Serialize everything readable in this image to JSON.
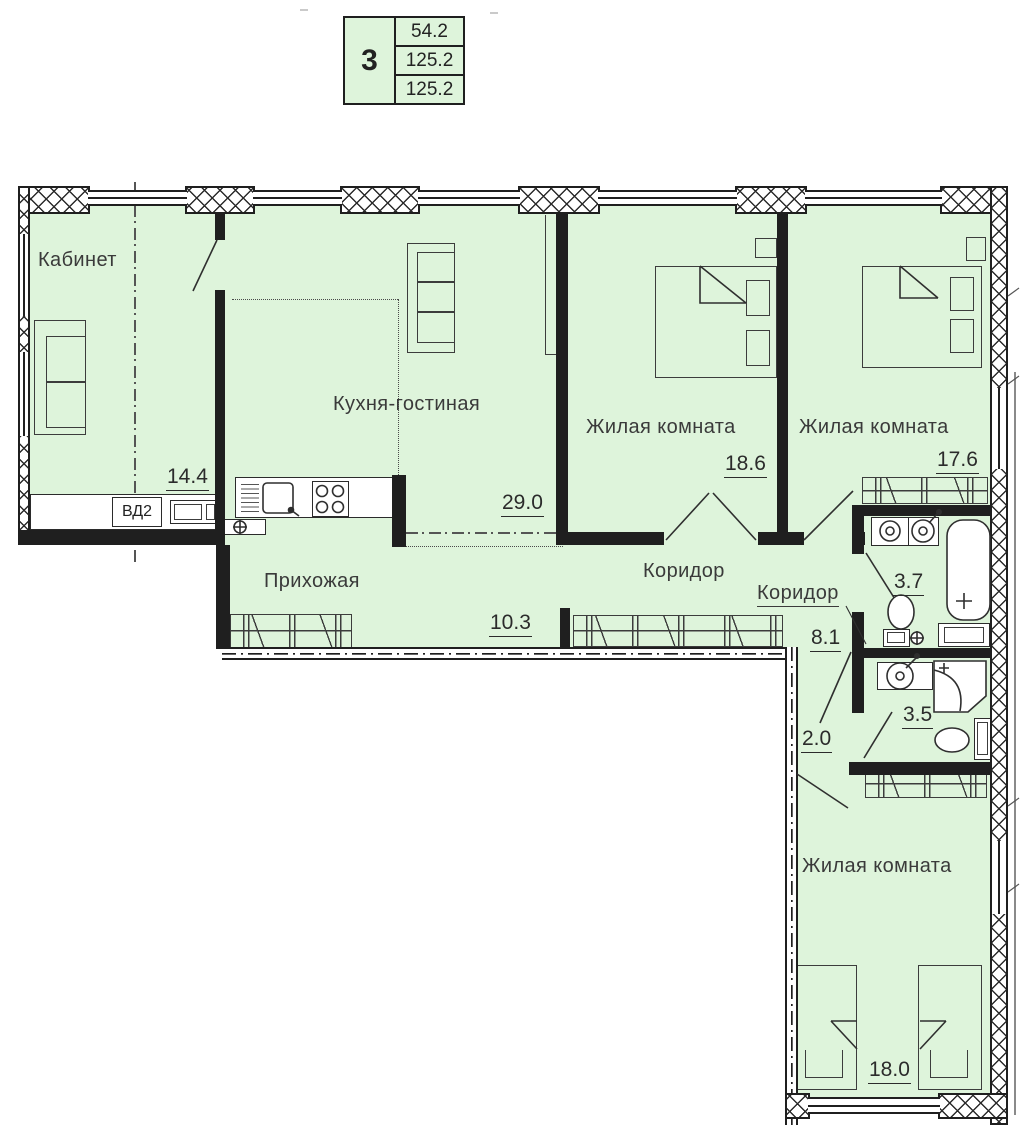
{
  "legend": {
    "rooms_count": "3",
    "area_living": "54.2",
    "area_total": "125.2",
    "area_full": "125.2"
  },
  "rooms": {
    "kabinet": {
      "name": "Кабинет",
      "area": "14.4"
    },
    "kitchen_living": {
      "name": "Кухня-гостиная",
      "area": "29.0"
    },
    "bedroom_top_left": {
      "name": "Жилая комната",
      "area": "18.6"
    },
    "bedroom_top_right": {
      "name": "Жилая комната",
      "area": "17.6"
    },
    "corridor_main": {
      "name": "Коридор",
      "area": "8.1"
    },
    "corridor_small": {
      "name": "Коридор",
      "area": "2.0"
    },
    "hallway": {
      "name": "Прихожая",
      "area": "10.3"
    },
    "bathroom_large": {
      "area": "3.7"
    },
    "bathroom_small": {
      "area": "3.5"
    },
    "bedroom_bottom": {
      "name": "Жилая комната",
      "area": "18.0"
    }
  },
  "annotations": {
    "duct_label": "ВД2"
  },
  "colors": {
    "room_fill": "#def4db",
    "wall": "#1f1f1f",
    "line": "#3c3c3c"
  }
}
